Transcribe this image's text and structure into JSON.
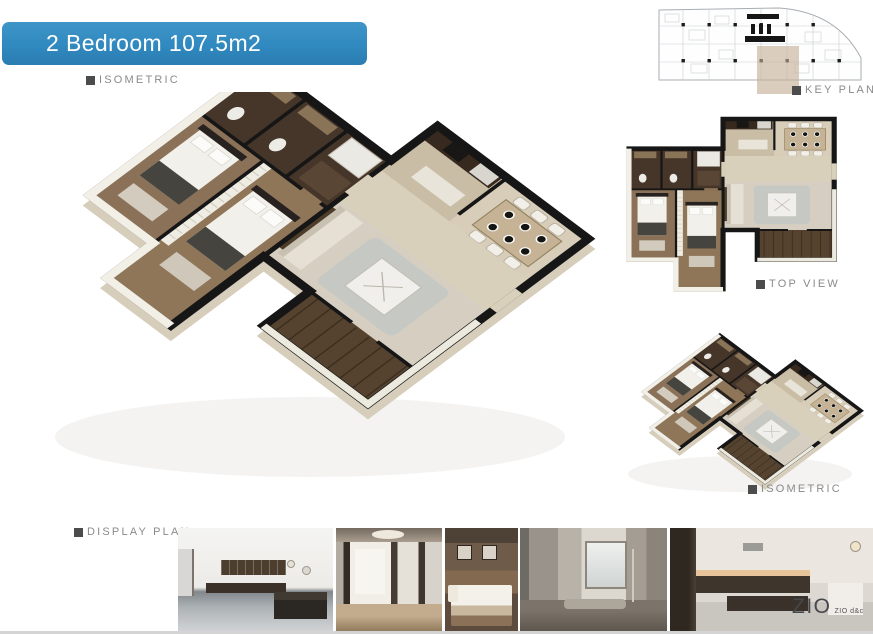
{
  "banner": {
    "title": "2 Bedroom 107.5m2"
  },
  "sections": {
    "isometric_main": {
      "label": "ISOMETRIC"
    },
    "key_plan": {
      "label": "KEY PLAN"
    },
    "top_view": {
      "label": "TOP VIEW"
    },
    "isometric_small": {
      "label": "ISOMETRIC"
    },
    "display_plan": {
      "label": "DISPLAY PLAN"
    }
  },
  "logo": {
    "brand": "ZIO",
    "suffix": "ZIO d&c"
  },
  "colors": {
    "banner_blue": "#3089bf",
    "label_text": "#8a8a8a",
    "bullet_gray": "#4c4c4c",
    "keyplan_highlight": "#c3ae94",
    "wall_black": "#161616",
    "floor_beige": "#ded4c2",
    "wet_room_brown": "#463529"
  },
  "photos": [
    {
      "name": "kitchen-dining"
    },
    {
      "name": "living-room"
    },
    {
      "name": "bedroom"
    },
    {
      "name": "bathroom"
    },
    {
      "name": "kitchen-island"
    }
  ]
}
